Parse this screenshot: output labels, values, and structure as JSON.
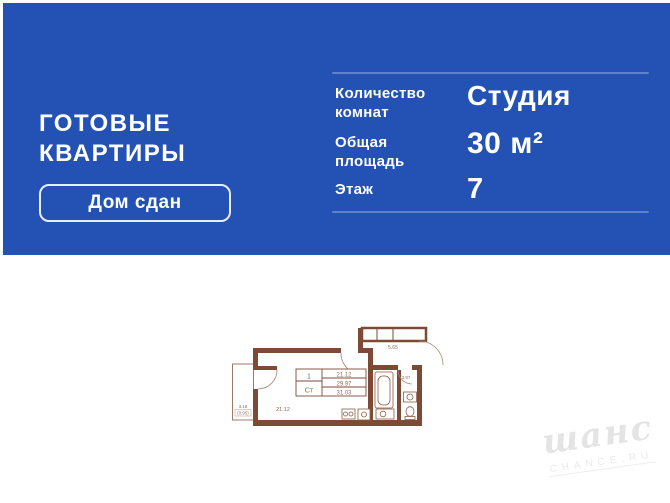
{
  "colors": {
    "banner_bg": "#2351b4",
    "wall": "#7d4a36",
    "plan_line": "#8a5b46",
    "plan_text": "#8d6f5e",
    "watermark": "#e4e4e4"
  },
  "banner": {
    "title_line1": "ГОТОВЫЕ",
    "title_line2": "КВАРТИРЫ",
    "badge_label": "Дом сдан",
    "specs": [
      {
        "label": "Количество комнат",
        "value": "Студия"
      },
      {
        "label": "Общая площадь",
        "value": "30 м²"
      },
      {
        "label": "Этаж",
        "value": "7"
      }
    ]
  },
  "floorplan": {
    "stamp": {
      "rooms": "1",
      "type_abbr": "Ст",
      "living_area": "21.12",
      "area_main": "29.97",
      "area_total": "31.03"
    },
    "labels": {
      "living_room": "21.12",
      "hallway": "5.65",
      "bathroom": "3.87",
      "balcony": "3.18",
      "balcony_reduced": "(0.95)"
    }
  },
  "watermark": {
    "script": "шанс",
    "caption": "CHANCE.RU"
  }
}
